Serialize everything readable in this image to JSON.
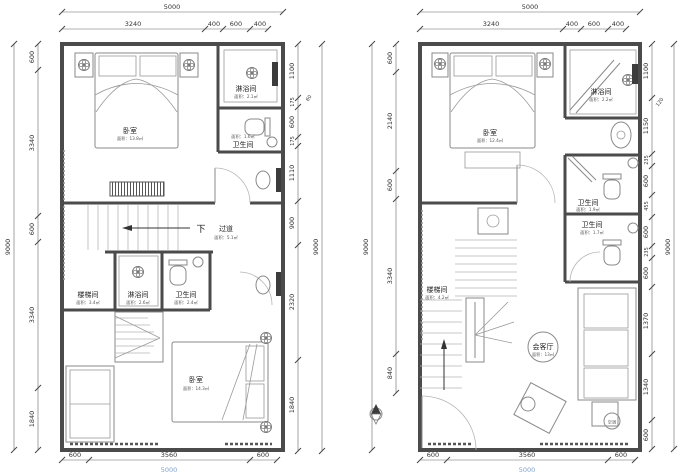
{
  "colors": {
    "wall_line": "#4b4b4b",
    "dim_text": "#333333",
    "faint_blue": "#7f9fc6"
  },
  "left_plan": {
    "top_total": "5000",
    "top_segs": [
      "3240",
      "400",
      "600",
      "400"
    ],
    "left_total": "9000",
    "left_segs": [
      "600",
      "3340",
      "600",
      "3340",
      "1840"
    ],
    "right_total": "9000",
    "right_offset": "60",
    "right_segs": [
      "1100",
      "175",
      "600",
      "175",
      "1110",
      "900",
      "2320",
      "1840"
    ],
    "bottom_segs": [
      "600",
      "3560",
      "600"
    ],
    "bottom_total": "5000",
    "rooms": {
      "bedroom_top": {
        "label": "卧室",
        "area": "面积：13.8㎡"
      },
      "shower_top": {
        "label": "淋浴间",
        "area": "面积：2.1㎡"
      },
      "wc_top": {
        "label": "卫生间",
        "area": "面积：1.6㎡"
      },
      "corridor": {
        "down": "下",
        "label": "过道",
        "area": "面积：5.1㎡"
      },
      "stairwell": {
        "label": "楼梯间",
        "area": "面积：3.4㎡"
      },
      "shower_mid": {
        "label": "淋浴间",
        "area": "面积：2.6㎡"
      },
      "wc_mid": {
        "label": "卫生间",
        "area": "面积：2.4㎡"
      },
      "bedroom_bottom": {
        "label": "卧室",
        "area": "面积：14.3㎡"
      }
    }
  },
  "right_plan": {
    "top_total": "5000",
    "top_segs": [
      "3240",
      "400",
      "600",
      "400"
    ],
    "left_total": "9000",
    "left_segs": [
      "600",
      "2140",
      "600",
      "3340",
      "840"
    ],
    "right_total": "9000",
    "right_offset": "120",
    "right_segs": [
      "1100",
      "1150",
      "235",
      "600",
      "455",
      "600",
      "235",
      "600",
      "1370",
      "1340",
      "600"
    ],
    "bottom_segs": [
      "600",
      "3560",
      "600"
    ],
    "bottom_total": "5000",
    "rooms": {
      "bedroom": {
        "label": "卧室",
        "area": "面积：12.4㎡"
      },
      "shower": {
        "label": "淋浴间",
        "area": "面积：2.2㎡"
      },
      "wc_upper": {
        "label": "卫生间",
        "area": "面积：1.9㎡"
      },
      "wc_lower": {
        "label": "卫生间",
        "area": "面积：1.7㎡"
      },
      "stairwell": {
        "label": "楼梯间",
        "area": "面积：4.2㎡"
      },
      "living": {
        "label": "会客厅",
        "area": "面积：13㎡"
      },
      "ac": {
        "label": "空调"
      },
      "up": "上"
    }
  }
}
